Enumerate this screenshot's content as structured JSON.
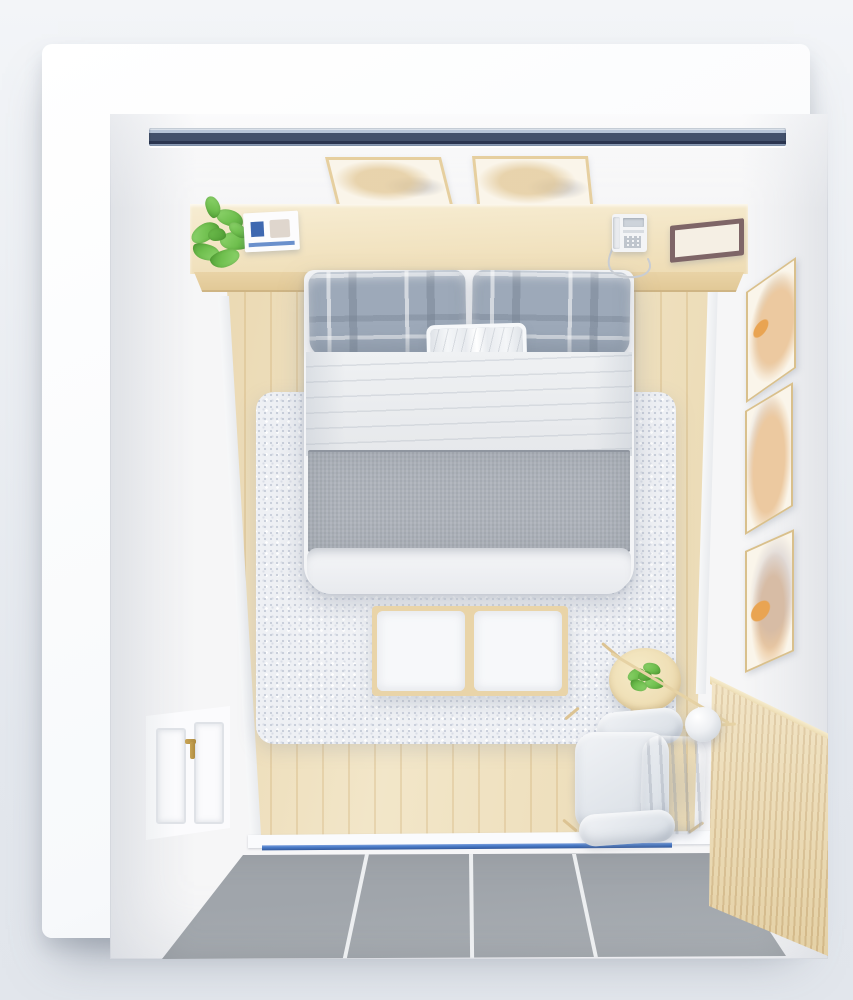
{
  "meta": {
    "type": "3d-render-photo",
    "description": "Bird's-eye top-down 3D rendering of a small minimalist Scandinavian-style bedroom",
    "view": "top-down"
  },
  "colors": {
    "bg-top": "#f3f5f8",
    "bg-bottom": "#e4e8ee",
    "card": "#f7f9fb",
    "room-wall": "#f6f6f7",
    "window-light": "#b6c4d8",
    "window-navy": "#42506b",
    "window-deep": "#2b3550",
    "wood-shelf-light": "#f7edd3",
    "wood-shelf": "#eedcb4",
    "wood-face": "#e9d3a6",
    "floor-plank": "#f0e2c0",
    "floor-groove": "#e3cda1",
    "rug-base": "#eef0f4",
    "rug-dot": "#c7cdd9",
    "rug-dot2": "#d9dde6",
    "plaid-base": "#9da9b9",
    "duvet-light": "#f3f4f6",
    "duvet": "#e6e8eb",
    "runner": "#aeb3bb",
    "runner-dark": "#8f959f",
    "bench-wood": "#e9d4a8",
    "cushion-white": "#f7f8fa",
    "table-wood": "#efdfb6",
    "table-wood-dark": "#ddc493",
    "plant-light": "#92d771",
    "plant-mid": "#6fbf4e",
    "plant-dark": "#4f9c34",
    "chair-light": "#f1f3f6",
    "chair-mid": "#dde2e8",
    "chair-dark": "#bfc7d1",
    "tile": "#a0a5ab",
    "tile-light": "#aaafb4",
    "grout": "#edeff1",
    "blue-line": "#4a7cc9",
    "blue-line-dark": "#33599c",
    "wainscot": "#eddbb1",
    "wainscot-groove": "#d8be8e",
    "frame-gold": "#d9c08c",
    "art-paper": "#faf5ea",
    "art-orange": "#e9a452",
    "art-peach": "#ecc9a0",
    "door-white": "#fbfbfd",
    "door-panel-line": "#dfe2e7",
    "brass": "#ae8b40",
    "phone-body": "#f3f4f6",
    "phone-screen": "#cdd3da",
    "phone-btn": "#bfc5cd",
    "cord": "#c9cdd3",
    "flat-frame": "#7e6567",
    "flat-frame-inner": "#f5efe4",
    "book-white": "#fcfcfd",
    "book-blue": "#3e68b0",
    "book-stripe": "#6a90cc"
  },
  "scene": {
    "labels": {
      "window": "recessed head-wall window",
      "ceilArtLeft": "framed botanical print on head wall (left)",
      "ceilArtRight": "framed botanical print on head wall (right)",
      "shelf": "wood headboard ledge",
      "plant": "green potted plant on ledge",
      "book": "white art book with blue label",
      "telephone": "white corded desk phone",
      "flatFrame": "dark wood picture frame lying flat on ledge",
      "bed": "double bed with white duvet",
      "pillowLeft": "gray plaid pillow (left)",
      "pillowRight": "gray plaid pillow (right)",
      "accentPillow": "small white accent pillow",
      "runner": "gray bed runner across duvet",
      "duvetFoot": "folded duvet edge at foot of bed",
      "rug": "fluffy light-gray area rug",
      "bench": "end-of-bed wood bench with two white cushions",
      "sideTable": "round wooden side table",
      "tablePlant": "small green plant on side table",
      "lamp": "spherical white floor lamp on wood stand",
      "armchair": "white upholstered armchair with wood frame",
      "wallArt1": "framed botanical print on right wall (top)",
      "wallArt2": "framed botanical print on right wall (middle)",
      "wallArt3": "framed botanical print on right wall (bottom)",
      "wainscot": "vertical wood-slat wainscoting on right wall",
      "door": "white paneled door with brass handle",
      "woodFloor": "light oak plank floor",
      "tileFloor": "gray tile entry floor",
      "threshold": "white threshold step",
      "blueTrack": "blue floor track strip at entry"
    }
  }
}
